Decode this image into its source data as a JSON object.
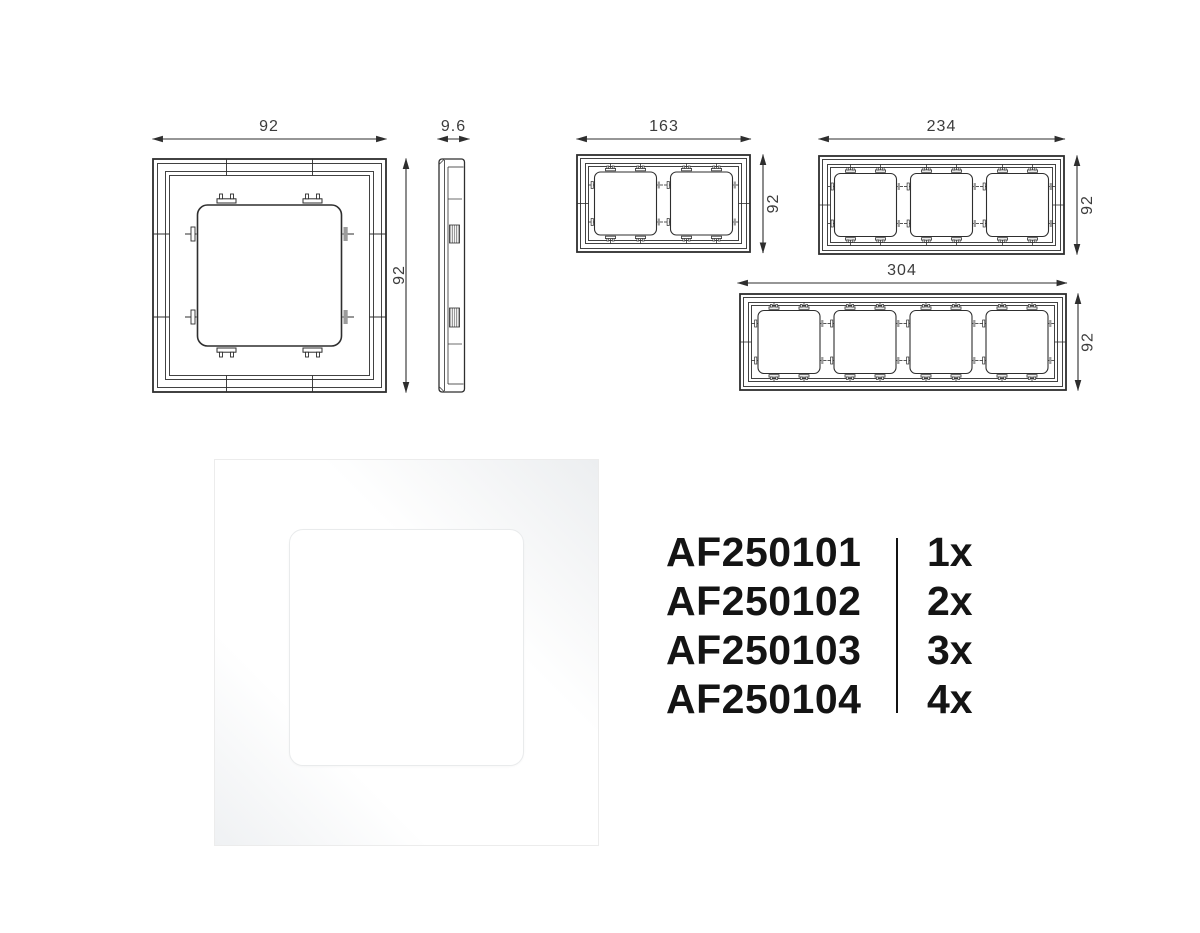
{
  "colors": {
    "line": "#2e2e2e",
    "dim_text": "#3c3c3c",
    "clip_fill": "#9c9c9c",
    "code_text": "#141414"
  },
  "drawings": {
    "single_frame": {
      "width_mm": "92",
      "height_mm": "92"
    },
    "side_profile": {
      "depth_mm": "9.6"
    },
    "frame_2gang": {
      "width_mm": "163",
      "height_mm": "92"
    },
    "frame_3gang": {
      "width_mm": "234",
      "height_mm": "92"
    },
    "frame_4gang": {
      "width_mm": "304",
      "height_mm": "92"
    }
  },
  "product_list": {
    "rows": [
      {
        "code": "AF250101",
        "qty": "1x"
      },
      {
        "code": "AF250102",
        "qty": "2x"
      },
      {
        "code": "AF250103",
        "qty": "3x"
      },
      {
        "code": "AF250104",
        "qty": "4x"
      }
    ]
  }
}
